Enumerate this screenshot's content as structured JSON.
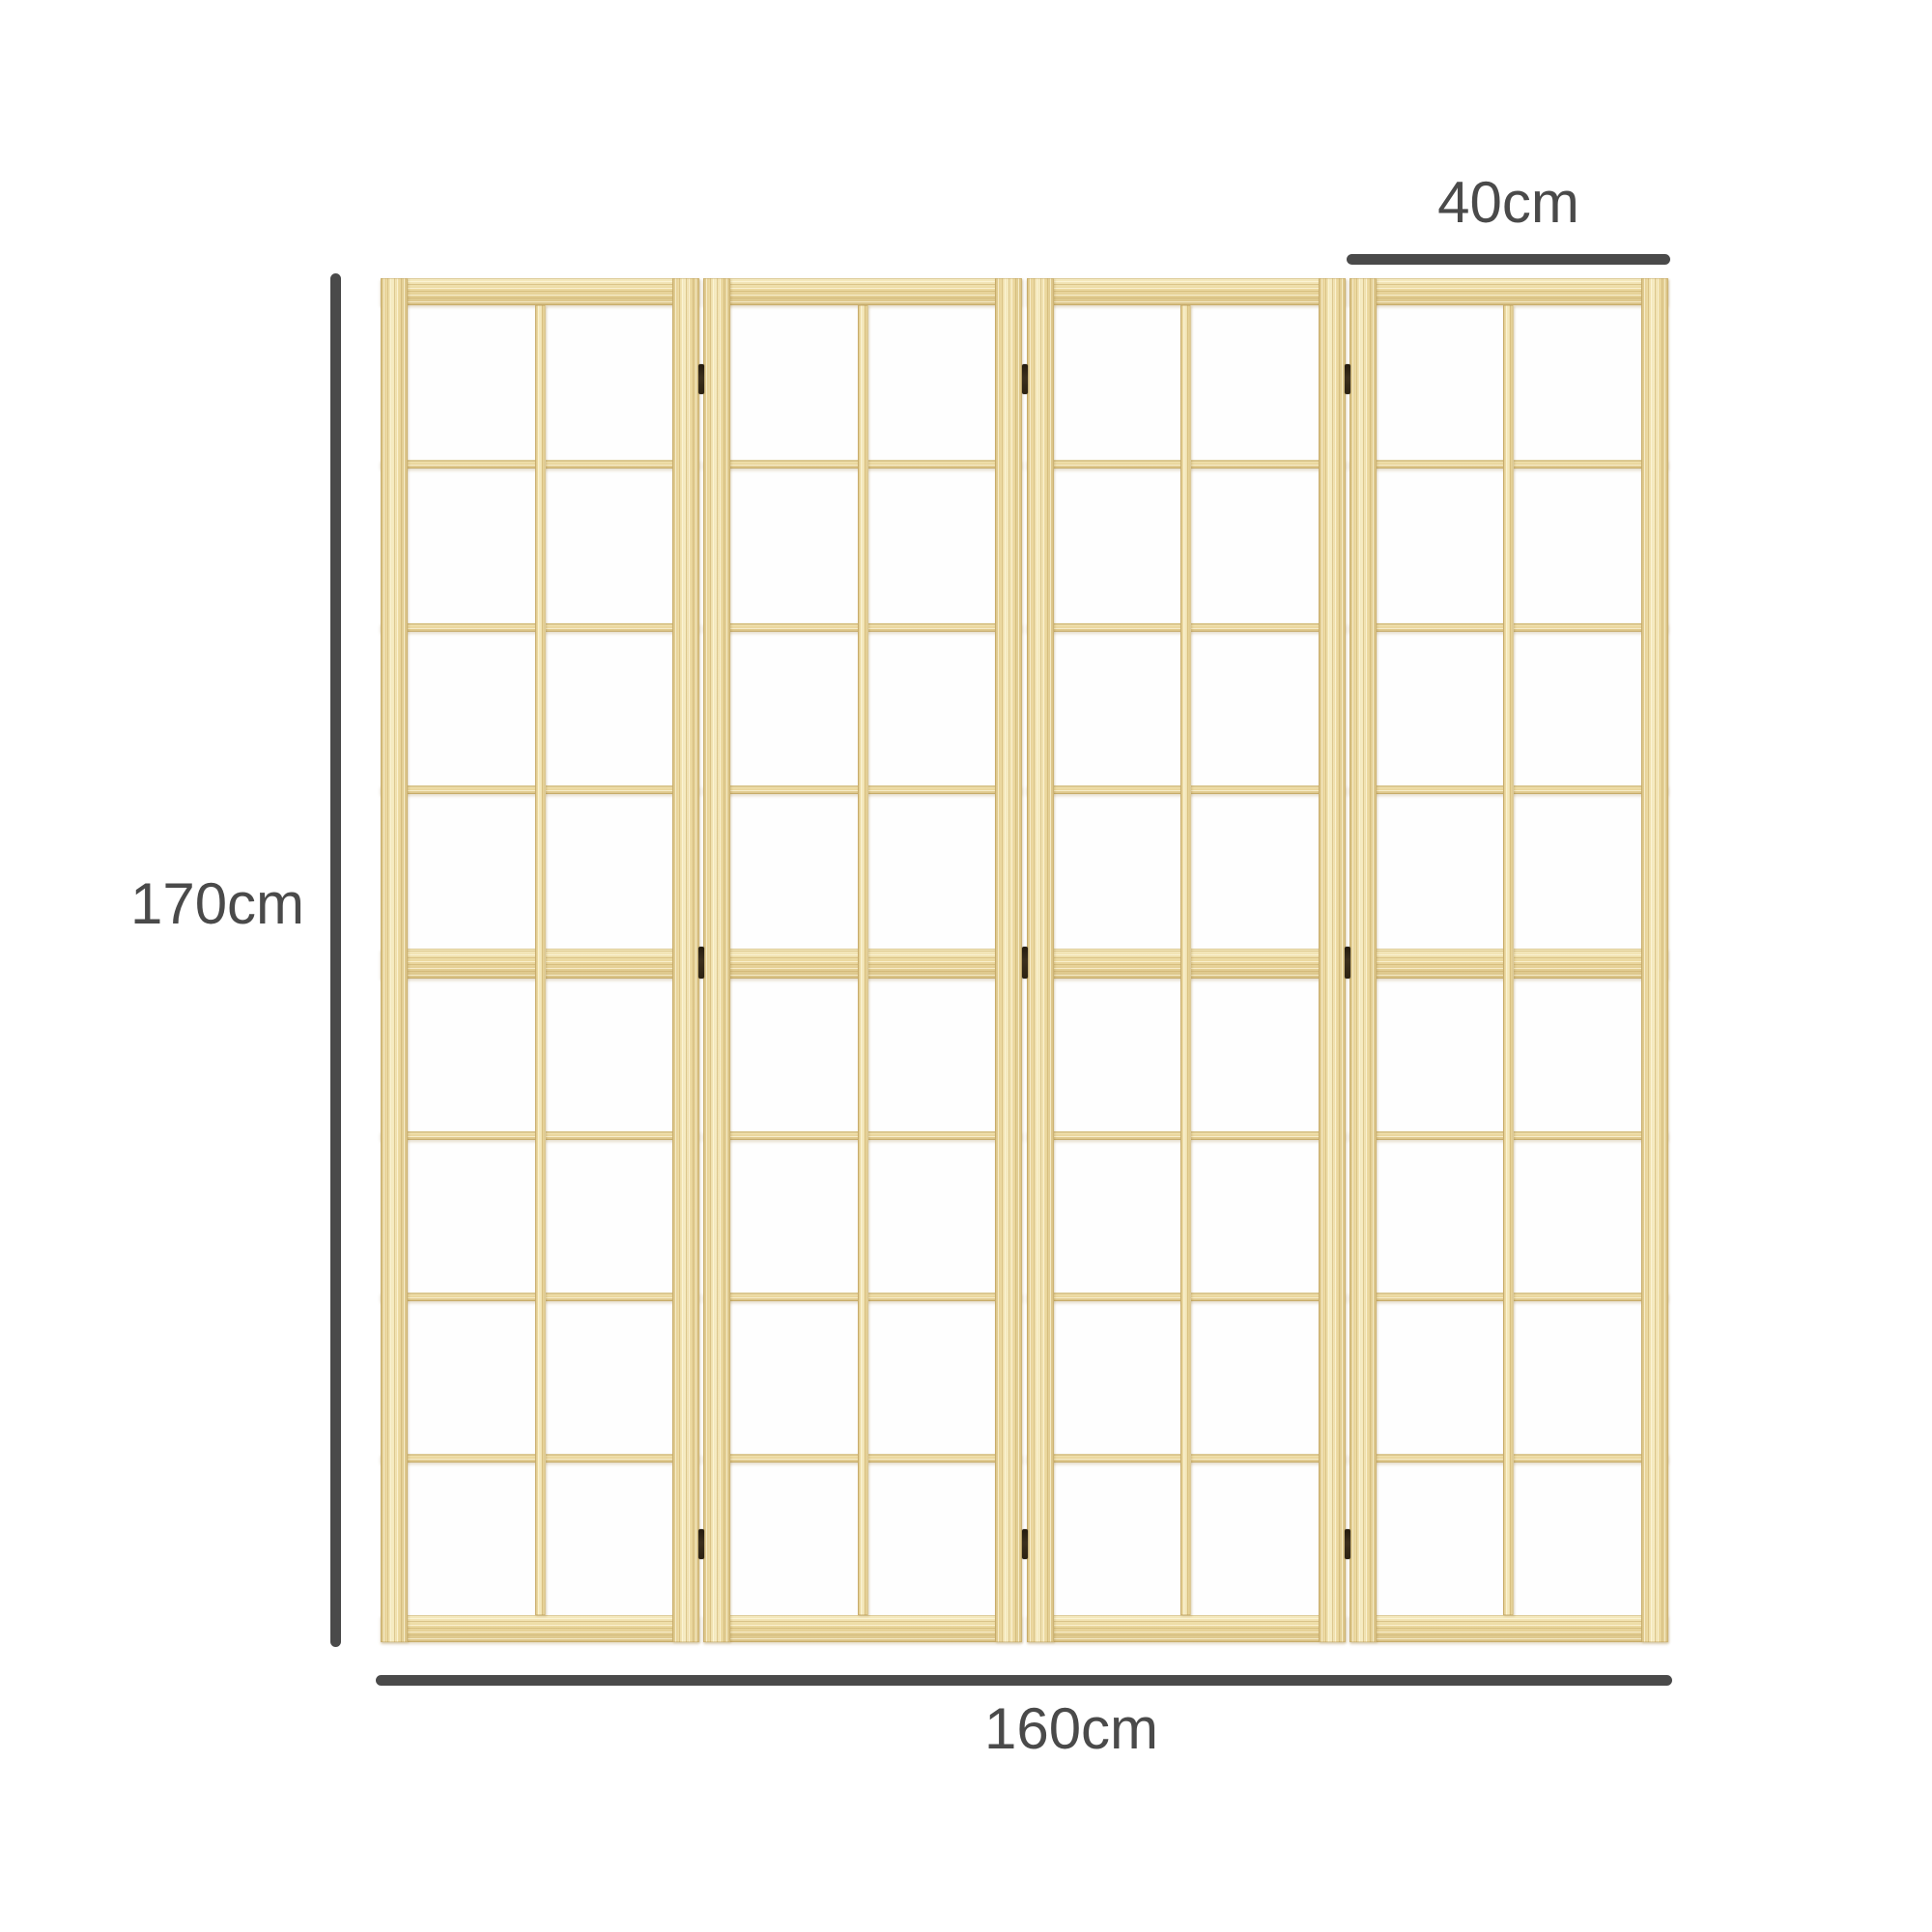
{
  "product": {
    "name": "4-panel shoji wooden room divider",
    "panel_count": 4,
    "grid_rows_per_panel": 8,
    "grid_cols_per_panel": 2,
    "hinge_junctions": 3,
    "hinges_per_junction": 3
  },
  "dimensions": {
    "height": {
      "label": "170cm"
    },
    "total_width": {
      "label": "160cm"
    },
    "panel_width": {
      "label": "40cm"
    }
  },
  "colors": {
    "background": "#ffffff",
    "paper": "#fefefe",
    "wood_base": "#ecd9a0",
    "wood_light": "#f6ecc4",
    "wood_dark": "#d9c286",
    "wood_edge": "#ba9b58",
    "hinge": "#3b2f1d",
    "dimension": "#4a4a4a"
  }
}
